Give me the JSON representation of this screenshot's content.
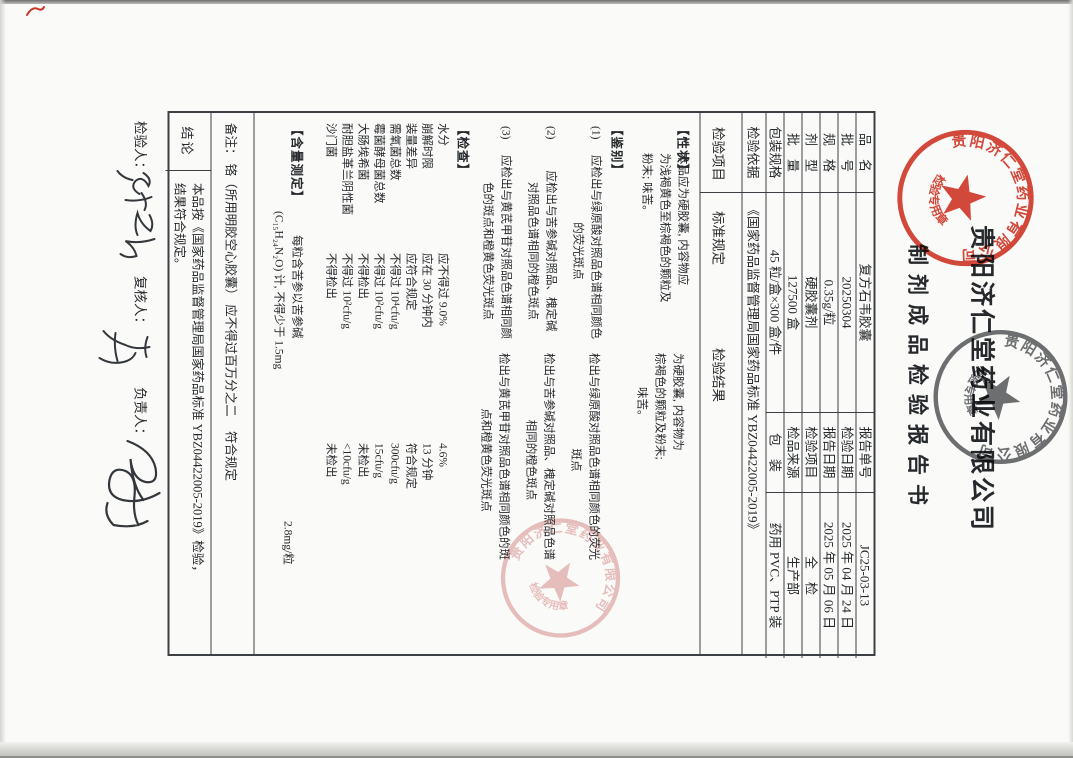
{
  "title": {
    "company": "贵阳济仁堂药业有限公司",
    "doc": "制剂成品检验报告书"
  },
  "header": {
    "rows": [
      {
        "l1": "品　名",
        "v1": "复方石韦胶囊",
        "l2": "报告单号",
        "v2": "JC25-03-13"
      },
      {
        "l1": "批　号",
        "v1": "20250304",
        "l2": "检验日期",
        "v2": "2025 年 04 月 24 日"
      },
      {
        "l1": "规　格",
        "v1": "0.35g/粒",
        "l2": "报告日期",
        "v2": "2025 年 05 月 06 日"
      },
      {
        "l1": "剂　型",
        "v1": "硬胶囊剂",
        "l2": "检验项目",
        "v2": "全　检"
      },
      {
        "l1": "批　量",
        "v1": "127500 盒",
        "l2": "检品来源",
        "v2": "生产部"
      },
      {
        "l1": "包装规格",
        "v1": "45 粒/盒×300 盒/件",
        "l2": "包　装",
        "v2": "药用 PVC、PTP 装"
      }
    ]
  },
  "basis": {
    "label": "检验依据",
    "value": "《国家药品监督管理局国家药品标准 YBZ04422005-2019》"
  },
  "cols": {
    "item": "检验项目",
    "standard": "标准规定",
    "result": "检验结果"
  },
  "body": {
    "xz": {
      "label": "【性状】",
      "std": [
        "本品应为硬胶囊, 内容物应",
        "为浅褐黄色至棕褐色的颗粒及",
        "粉末; 味苦。"
      ],
      "res": [
        "为硬胶囊, 内容物为",
        "棕褐色的颗粒及粉末;",
        "味苦。"
      ]
    },
    "jb": {
      "label": "【鉴别】",
      "items": [
        {
          "no": "(1)",
          "std1": "应检出与绿原酸对照品色谱相同颜色",
          "std2": "的荧光斑点",
          "res1": "检出与绿原酸对照品色谱相同颜色的荧光",
          "res2": "斑点"
        },
        {
          "no": "(2)",
          "std1": "应检出与苦参碱对照品、槐定碱",
          "std2": "对照品色谱相同的橙色斑点",
          "res1": "检出与苦参碱对照品、槐定碱对照品色谱",
          "res2": "相同的橙色斑点"
        },
        {
          "no": "(3)",
          "std1": "应检出与黄芪甲苷对照品色谱相同颜",
          "std2": "色的斑点和橙黄色荧光斑点",
          "res1": "检出与黄芪甲苷对照品色谱相同颜色的斑",
          "res2": "点和橙黄色荧光斑点"
        }
      ]
    },
    "jc": {
      "label": "【检查】",
      "items": [
        {
          "name": "水分",
          "std": "应不得过 9.0%",
          "res": "4.6%"
        },
        {
          "name": "崩解时限",
          "std": "应在 30 分钟内",
          "res": "13 分钟"
        },
        {
          "name": "装量差异",
          "std": "应符合规定",
          "res": "符合规定"
        },
        {
          "name": "需氧菌总数",
          "std": "不得过 10⁴cfu/g",
          "res": "300cfu/g"
        },
        {
          "name": "霉菌酵母菌总数",
          "std": "不得过 10²cfu/g",
          "res": "15cfu/g"
        },
        {
          "name": "大肠埃希菌",
          "std": "不得检出",
          "res": "未检出"
        },
        {
          "name": "耐胆盐革兰阴性菌",
          "std": "不得过 10²cfu/g",
          "res": "<10cfu/g"
        },
        {
          "name": "沙门菌",
          "std": "不得检出",
          "res": "未检出"
        }
      ]
    },
    "hl": {
      "label": "【含量测定】",
      "std1": "每粒含苦参以苦参碱",
      "std2": "(C₁₅H₂₄N₂O) 计, 不得少于 1.5mg",
      "res": "2.8mg/粒"
    }
  },
  "remark": {
    "text": "备注： 铬（所用明胶空心胶囊） 应不得过百万分之二",
    "result": "符合规定"
  },
  "conclusion": {
    "label": "结论",
    "line1": "本品按《国家药品监督管理局国家药品标准 YBZ04422005-2019》检验，",
    "line2": "结果符合规定。"
  },
  "signatures": {
    "inspector_label": "检验人：",
    "reviewer_label": "复核人：",
    "supervisor_label": "负责人："
  },
  "seals": {
    "red": {
      "ring": "贵阳济仁堂药业有限公司",
      "banner": "检验专用章",
      "color": "#d43a2b"
    },
    "black": {
      "ring": "贵阳济仁堂药业有限公司",
      "banner": "检验专用章",
      "color": "#4a4c50"
    },
    "pink": {
      "ring": "贵阳济仁堂药业有限公司",
      "banner": "检验专用章",
      "color": "#d88f8d"
    }
  }
}
